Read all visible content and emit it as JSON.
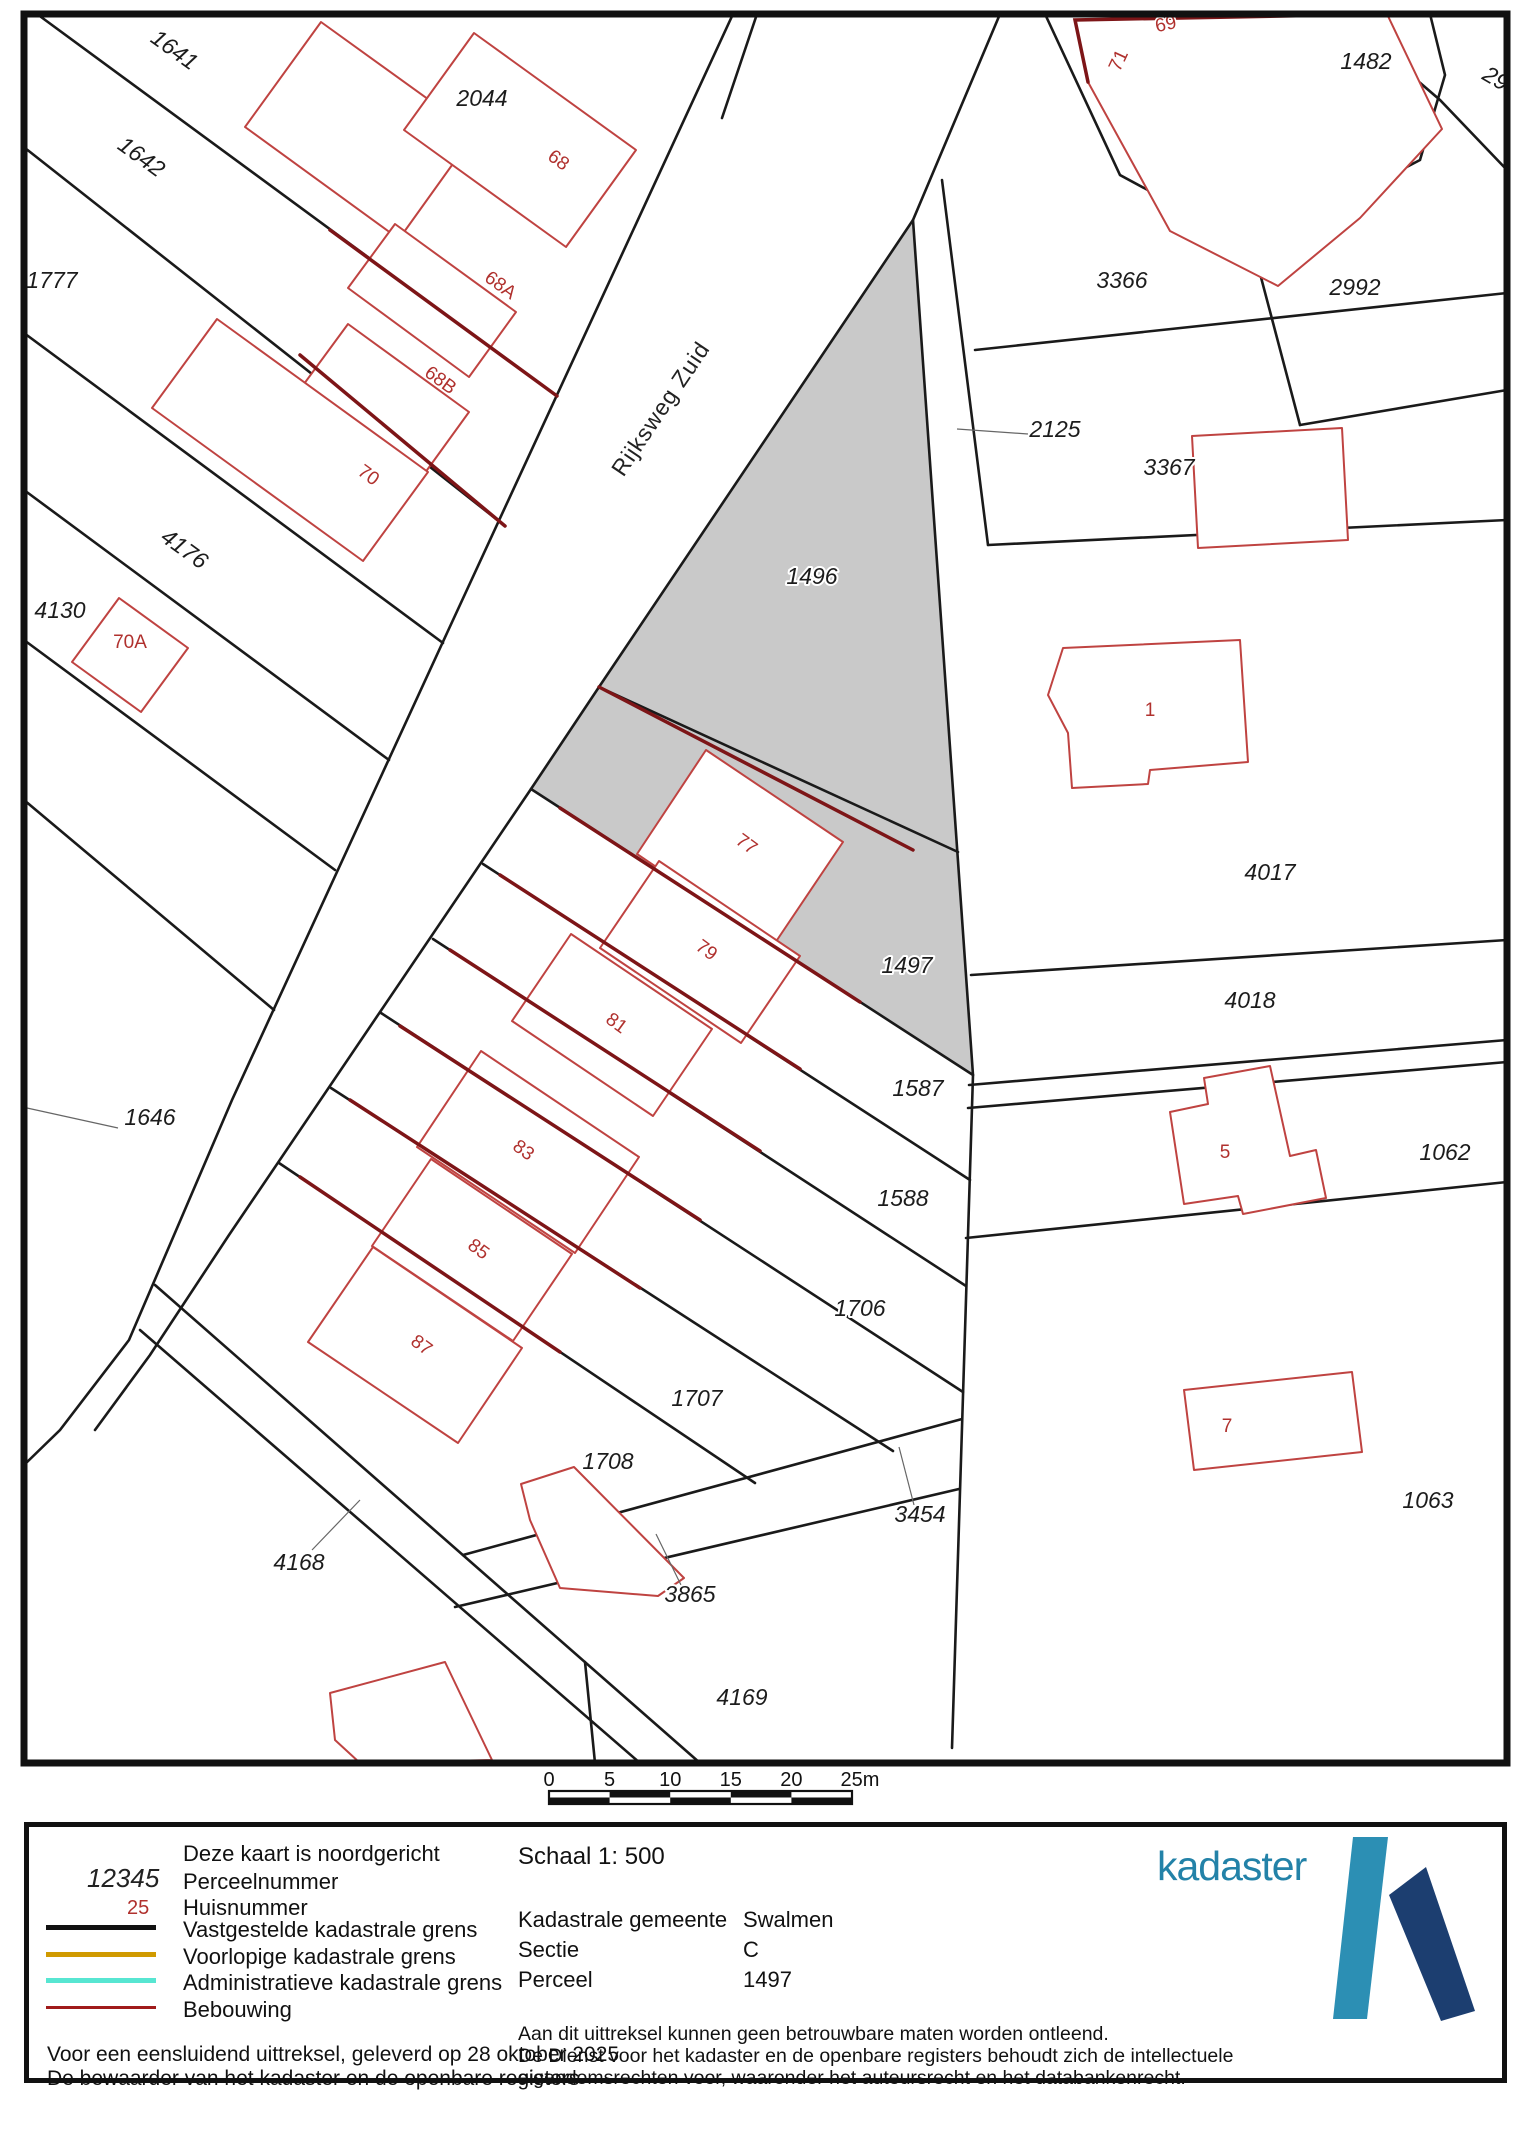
{
  "map": {
    "road_label": {
      "text": "Rijksweg Zuid",
      "x": 667,
      "y": 413,
      "rot": -56
    },
    "parcel_labels": [
      {
        "text": "1641",
        "x": 170,
        "y": 56,
        "rot": 36
      },
      {
        "text": "1642",
        "x": 137,
        "y": 163,
        "rot": 36
      },
      {
        "text": "1777",
        "x": 52,
        "y": 288,
        "rot": 0
      },
      {
        "text": "2044",
        "x": 482,
        "y": 106,
        "rot": 0
      },
      {
        "text": "4176",
        "x": 180,
        "y": 555,
        "rot": 36
      },
      {
        "text": "4130",
        "x": 60,
        "y": 618,
        "rot": 0
      },
      {
        "text": "1646",
        "x": 150,
        "y": 1125,
        "rot": 0
      },
      {
        "text": "1496",
        "x": 812,
        "y": 584,
        "rot": 0
      },
      {
        "text": "2125",
        "x": 1055,
        "y": 437,
        "rot": 0
      },
      {
        "text": "3366",
        "x": 1122,
        "y": 288,
        "rot": 0
      },
      {
        "text": "3367",
        "x": 1169,
        "y": 475,
        "rot": 0
      },
      {
        "text": "2992",
        "x": 1355,
        "y": 295,
        "rot": 0
      },
      {
        "text": "1482",
        "x": 1366,
        "y": 69,
        "rot": 0
      },
      {
        "text": "29",
        "x": 1492,
        "y": 85,
        "rot": 30
      },
      {
        "text": "1497",
        "x": 907,
        "y": 973,
        "rot": 0
      },
      {
        "text": "4017",
        "x": 1270,
        "y": 880,
        "rot": 0
      },
      {
        "text": "4018",
        "x": 1250,
        "y": 1008,
        "rot": 0
      },
      {
        "text": "1587",
        "x": 918,
        "y": 1096,
        "rot": 0
      },
      {
        "text": "1588",
        "x": 903,
        "y": 1206,
        "rot": 0
      },
      {
        "text": "1062",
        "x": 1445,
        "y": 1160,
        "rot": 0
      },
      {
        "text": "1706",
        "x": 860,
        "y": 1316,
        "rot": 0
      },
      {
        "text": "1707",
        "x": 697,
        "y": 1406,
        "rot": 0
      },
      {
        "text": "1708",
        "x": 608,
        "y": 1469,
        "rot": 0
      },
      {
        "text": "3454",
        "x": 920,
        "y": 1522,
        "rot": 0
      },
      {
        "text": "3865",
        "x": 690,
        "y": 1602,
        "rot": 0
      },
      {
        "text": "4168",
        "x": 299,
        "y": 1570,
        "rot": 0
      },
      {
        "text": "4169",
        "x": 742,
        "y": 1705,
        "rot": 0
      },
      {
        "text": "1063",
        "x": 1428,
        "y": 1508,
        "rot": 0
      }
    ],
    "house_labels": [
      {
        "text": "68",
        "x": 555,
        "y": 165,
        "rot": 36
      },
      {
        "text": "68A",
        "x": 497,
        "y": 290,
        "rot": 36
      },
      {
        "text": "68B",
        "x": 437,
        "y": 385,
        "rot": 36
      },
      {
        "text": "70",
        "x": 365,
        "y": 480,
        "rot": 36
      },
      {
        "text": "70A",
        "x": 130,
        "y": 648,
        "rot": 0
      },
      {
        "text": "69",
        "x": 1167,
        "y": 30,
        "rot": -12
      },
      {
        "text": "71",
        "x": 1124,
        "y": 63,
        "rot": -65
      },
      {
        "text": "77",
        "x": 743,
        "y": 849,
        "rot": 36
      },
      {
        "text": "79",
        "x": 703,
        "y": 955,
        "rot": 36
      },
      {
        "text": "81",
        "x": 613,
        "y": 1028,
        "rot": 36
      },
      {
        "text": "83",
        "x": 520,
        "y": 1155,
        "rot": 36
      },
      {
        "text": "85",
        "x": 475,
        "y": 1254,
        "rot": 36
      },
      {
        "text": "87",
        "x": 418,
        "y": 1350,
        "rot": 36
      },
      {
        "text": "1",
        "x": 1150,
        "y": 716,
        "rot": 0
      },
      {
        "text": "5",
        "x": 1225,
        "y": 1158,
        "rot": 0
      },
      {
        "text": "7",
        "x": 1227,
        "y": 1432,
        "rot": 0
      }
    ],
    "colors": {
      "selected_parcel_fill": "#c9c9c9",
      "boundary_line": "#1a1a1a",
      "building_outline": "#bf4341",
      "building_bold": "#7d1517",
      "parcel_label": "#1c1c1c",
      "house_label": "#b0312e"
    }
  },
  "scalebar": {
    "ticks": [
      "0",
      "5",
      "10",
      "15",
      "20",
      "25m"
    ]
  },
  "legend": {
    "north_note": "Deze kaart is noordgericht",
    "perceel_sample": "12345",
    "perceel_label": "Perceelnummer",
    "huis_sample": "25",
    "huis_label": "Huisnummer",
    "line_items": [
      {
        "key": "vastgesteld",
        "label": "Vastgestelde kadastrale grens",
        "color": "#111111"
      },
      {
        "key": "voorlopig",
        "label": "Voorlopige kadastrale grens",
        "color": "#d09a00"
      },
      {
        "key": "administratief",
        "label": "Administratieve kadastrale grens",
        "color": "#57e6d2"
      },
      {
        "key": "bebouwing",
        "label": "Bebouwing",
        "color": "#a01b1b"
      }
    ],
    "issued_line1": "Voor een eensluidend uittreksel, geleverd op 28 oktober 2025",
    "issued_line2": "De bewaarder van het kadaster en de openbare registers",
    "schaal": "Schaal 1: 500",
    "fields": [
      {
        "label": "Kadastrale gemeente",
        "value": "Swalmen"
      },
      {
        "label": "Sectie",
        "value": "C"
      },
      {
        "label": "Perceel",
        "value": "1497"
      }
    ],
    "disclaimer": [
      "Aan dit uittreksel kunnen geen betrouwbare maten worden ontleend.",
      "De Dienst voor het kadaster en de openbare registers behoudt zich de intellectuele",
      "eigendomsrechten voor, waaronder het auteursrecht en het databankenrecht."
    ],
    "brand": "kadaster"
  }
}
